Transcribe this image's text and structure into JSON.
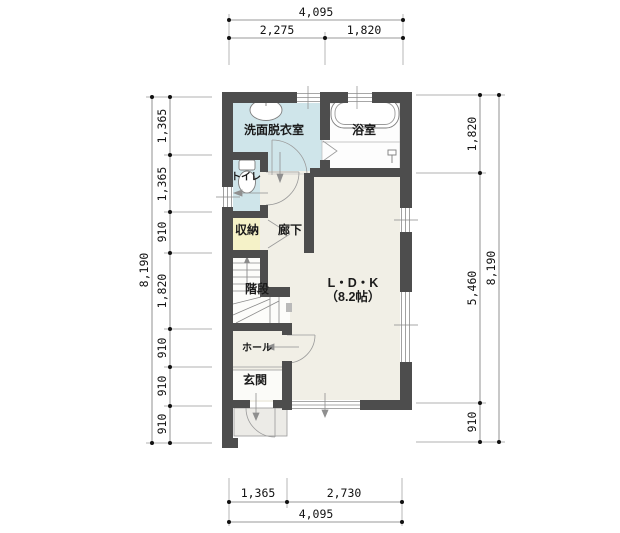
{
  "plan": {
    "title": "1F floor plan",
    "unit_note": "dimensions in millimetres",
    "colors": {
      "wall": "#4d4d4d",
      "wet_room_fill": "#cfe5ea",
      "storage_fill": "#f5f2c8",
      "floor_fill": "#f1efe6",
      "bath_fill": "#fdfdfd",
      "porch_fill": "#ecebe7",
      "line": "#8a8a8a"
    }
  },
  "rooms": {
    "washroom": {
      "label": "洗面脱衣室"
    },
    "bath": {
      "label": "浴室"
    },
    "toilet": {
      "label": "トイレ"
    },
    "storage": {
      "label": "収納"
    },
    "corridor": {
      "label": "廊下"
    },
    "stairs": {
      "label": "階段"
    },
    "hall": {
      "label": "ホール"
    },
    "entrance": {
      "label": "玄関"
    },
    "ldk": {
      "label": "L・D・K",
      "size": "（8.2帖）"
    }
  },
  "dims": {
    "top_total": "4,095",
    "top_seg1": "2,275",
    "top_seg2": "1,820",
    "left_total": "8,190",
    "left_seg1": "1,365",
    "left_seg2": "1,365",
    "left_seg3": "910",
    "left_seg4": "1,820",
    "left_seg5": "910",
    "left_seg6": "910",
    "left_seg7": "910",
    "right_total": "8,190",
    "right_seg1": "1,820",
    "right_seg2": "5,460",
    "right_seg3": "910",
    "bottom_total": "4,095",
    "bottom_seg1": "1,365",
    "bottom_seg2": "2,730"
  }
}
